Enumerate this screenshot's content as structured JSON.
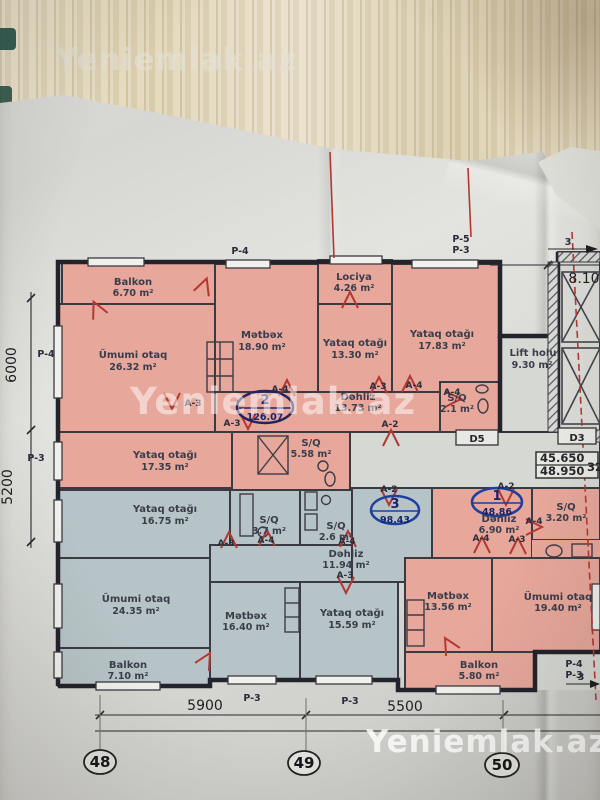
{
  "watermark": {
    "text": "Yeniemlak.az"
  },
  "colors": {
    "apartment_pink": "#e7a79b",
    "apartment_blue": "#b7c4c7",
    "corridor_gray": "#d6d8d3",
    "door_red": "#b43832",
    "badge_blue": "#1d3fa0",
    "wall_dark": "#26262e"
  },
  "rooms": {
    "apt2_balkon": {
      "name": "Balkon",
      "area": "6.70 m²"
    },
    "apt2_umumi": {
      "name": "Ümumi otaq",
      "area": "26.32 m²"
    },
    "apt2_metbex": {
      "name": "Mətbəx",
      "area": "18.90 m²"
    },
    "apt2_lociya": {
      "name": "Lociya",
      "area": "4.26 m²"
    },
    "apt2_yataq1": {
      "name": "Yataq otağı",
      "area": "13.30 m²"
    },
    "apt2_yataq2": {
      "name": "Yataq otağı",
      "area": "17.83 m²"
    },
    "apt2_dehliz": {
      "name": "Dəhliz",
      "area": "13.73 m²"
    },
    "apt2_sq1": {
      "name": "S/Q",
      "area": "2.1 m²"
    },
    "apt2_yataq3": {
      "name": "Yataq otağı",
      "area": "17.35 m²"
    },
    "apt2_sq2": {
      "name": "S/Q",
      "area": "5.58 m²"
    },
    "lift": {
      "name": "Lift holu",
      "area": "9.30 m²"
    },
    "apt3_yataq1": {
      "name": "Yataq otağı",
      "area": "16.75 m²"
    },
    "apt3_sq1": {
      "name": "S/Q",
      "area": "3.7 m²"
    },
    "apt3_sq2": {
      "name": "S/Q",
      "area": "2.6 m²"
    },
    "apt3_dehliz": {
      "name": "Dəhliz",
      "area": "11.94 m²"
    },
    "apt3_umumi": {
      "name": "Ümumi otaq",
      "area": "24.35 m²"
    },
    "apt3_metbex": {
      "name": "Mətbəx",
      "area": "16.40 m²"
    },
    "apt3_yataq2": {
      "name": "Yataq otağı",
      "area": "15.59 m²"
    },
    "apt3_balkon": {
      "name": "Balkon",
      "area": "7.10 m²"
    },
    "apt1_dehliz": {
      "name": "Dəhliz",
      "area": "6.90 m²"
    },
    "apt1_sq": {
      "name": "S/Q",
      "area": "3.20 m²"
    },
    "apt1_metbex": {
      "name": "Mətbəx",
      "area": "13.56 m²"
    },
    "apt1_umumi": {
      "name": "Ümumi otaq",
      "area": "19.40 m²"
    },
    "apt1_balkon": {
      "name": "Balkon",
      "area": "5.80 m²"
    }
  },
  "badges": {
    "apt2": {
      "num": "2",
      "area": "126.07"
    },
    "apt3": {
      "num": "3",
      "area": "98.43"
    },
    "apt1": {
      "num": "1",
      "area": "48.86"
    }
  },
  "grid": {
    "axes": [
      "48",
      "49",
      "50"
    ],
    "dims_bottom": [
      "5900",
      "5500"
    ],
    "dims_left": [
      "6000",
      "5200"
    ],
    "dim_right": "8.10",
    "elevations": [
      "45.650",
      "48.950"
    ],
    "partial_right": "32",
    "arrow_label": "3"
  },
  "p_labels": [
    "P-4",
    "P-5",
    "P-3",
    "P-4",
    "P-3",
    "P-3",
    "P-3",
    "P-4",
    "P-3"
  ],
  "a_labels": [
    "A-3",
    "A-4",
    "A-3",
    "A-3",
    "A-4",
    "A-2",
    "A-4",
    "A-2",
    "A-2",
    "A-3",
    "A-4",
    "A-4",
    "A-3",
    "A-4",
    "A-3",
    "A-4"
  ],
  "d_labels": [
    "D5",
    "D3"
  ]
}
